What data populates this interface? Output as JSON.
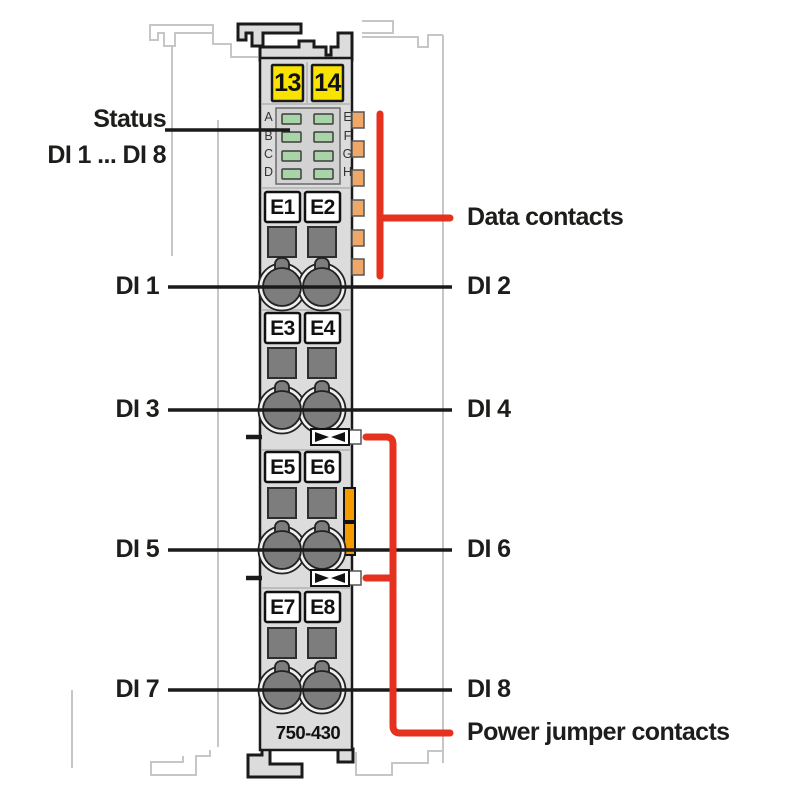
{
  "diagram": {
    "module_number": "750-430",
    "power_terminal_numbers": [
      "13",
      "14"
    ],
    "led_block": {
      "left_letters": [
        "A",
        "B",
        "C",
        "D"
      ],
      "right_letters": [
        "E",
        "F",
        "G",
        "H"
      ]
    },
    "terminals": [
      "E1",
      "E2",
      "E3",
      "E4",
      "E5",
      "E6",
      "E7",
      "E8"
    ],
    "labels": {
      "status": "Status",
      "status_channels": "DI 1 ... DI 8",
      "data_contacts": "Data contacts",
      "power_jumper_contacts": "Power jumper contacts",
      "channels_left": [
        "DI 1",
        "DI 3",
        "DI 5",
        "DI 7"
      ],
      "channels_right": [
        "DI 2",
        "DI 4",
        "DI 6",
        "DI 8"
      ]
    },
    "colors": {
      "callout_red": "#E5321F",
      "terminal_yellow": "#F9E300",
      "latch_orange": "#F59B00",
      "data_contact_orange": "#F0A868",
      "led_green": "#A8D4A8",
      "body_gray": "#DCDCDC"
    }
  }
}
